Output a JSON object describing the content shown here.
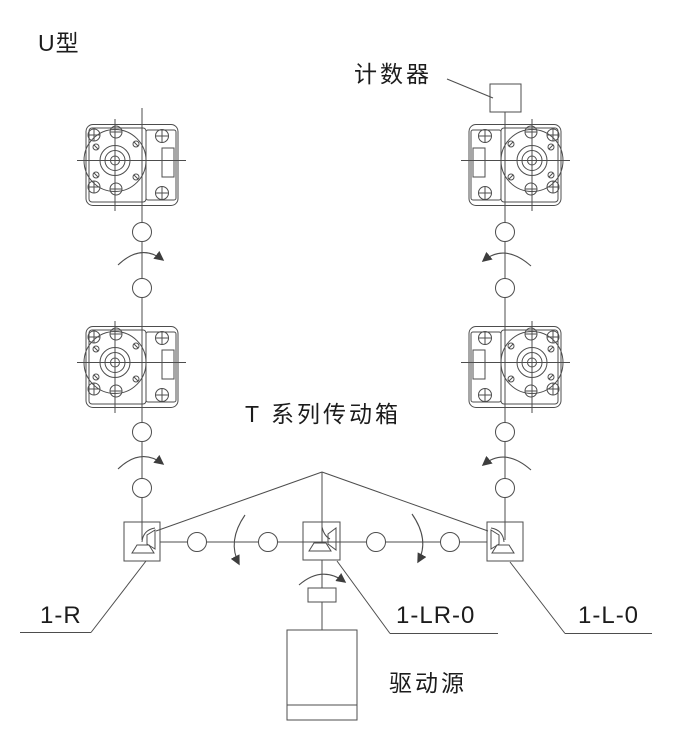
{
  "title": {
    "text": "U型"
  },
  "annotations": {
    "counter": {
      "label": "计数器"
    },
    "gearbox_series": {
      "label": "T 系列传动箱"
    },
    "drive_source": {
      "label": "驱动源"
    },
    "model_left": {
      "label": "1-R"
    },
    "model_center": {
      "label": "1-LR-0"
    },
    "model_right": {
      "label": "1-L-0"
    }
  },
  "colors": {
    "background": "#ffffff",
    "line": "#4d4d4d",
    "text": "#1c1c1c"
  },
  "diagram": {
    "layout_type": "U型",
    "components": [
      {
        "name": "counter-box",
        "label": "计数器",
        "count": 1
      },
      {
        "name": "t-series-gearbox",
        "label": "T 系列传动箱",
        "count": 4
      },
      {
        "name": "corner-drive",
        "models": [
          "1-R",
          "1-LR-0",
          "1-L-0"
        ],
        "count": 3
      },
      {
        "name": "drive-source",
        "label": "驱动源",
        "count": 1
      },
      {
        "name": "shaft-coupling",
        "count": 12
      },
      {
        "name": "rotation-arrow",
        "count": 7
      }
    ]
  }
}
